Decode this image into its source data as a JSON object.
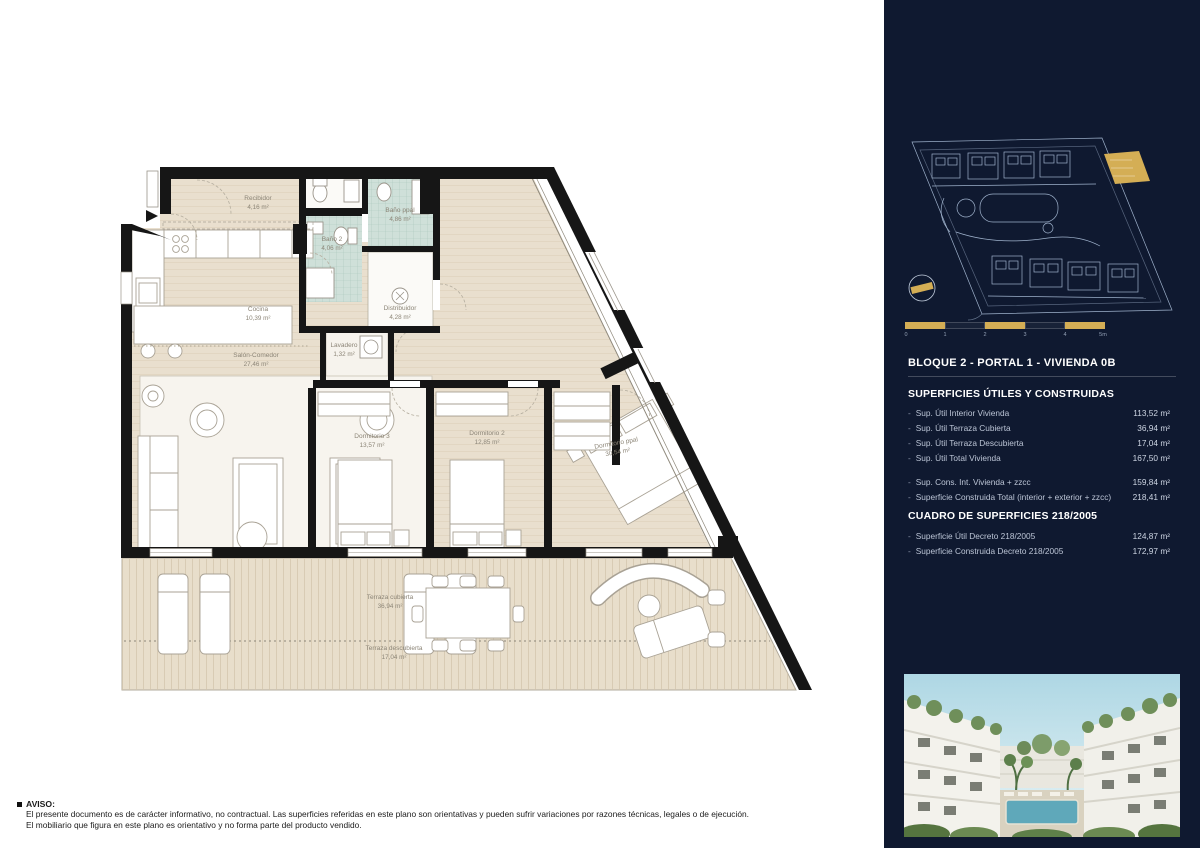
{
  "colors": {
    "navy": "#0f1930",
    "gold": "#d4ae55",
    "floor_beige": "#e9dfce",
    "bath_teal": "#cfe0d9"
  },
  "floorplan": {
    "rooms": {
      "recibidor": {
        "name": "Recibidor",
        "area": "4,16 m²"
      },
      "cocina": {
        "name": "Cocina",
        "area": "10,39 m²"
      },
      "bano2": {
        "name": "Baño 2",
        "area": "4,06 m²"
      },
      "banoppal": {
        "name": "Baño ppal",
        "area": "4,86 m²"
      },
      "distribuidor": {
        "name": "Distribuidor",
        "area": "4,28 m²"
      },
      "lavadero": {
        "name": "Lavadero",
        "area": "1,32 m²"
      },
      "salon": {
        "name": "Salón-Comedor",
        "area": "27,46 m²"
      },
      "dorm3": {
        "name": "Dormitorio 3",
        "area": "13,57 m²"
      },
      "dorm2": {
        "name": "Dormitorio 2",
        "area": "12,85 m²"
      },
      "dormppal": {
        "name": "Dormitorio ppal",
        "area": "30,54 m²"
      },
      "terraza_cub": {
        "name": "Terraza cubierta",
        "area": "36,94 m²"
      },
      "terraza_desc": {
        "name": "Terraza descubierta",
        "area": "17,04 m²"
      }
    }
  },
  "sidebar": {
    "unit_title": "BLOQUE 2 - PORTAL 1 - VIVIENDA 0B",
    "superficies": {
      "title": "SUPERFICIES ÚTILES Y CONSTRUIDAS",
      "rows": [
        {
          "label": "Sup. Útil Interior Vivienda",
          "value": "113,52 m²"
        },
        {
          "label": "Sup. Útil Terraza Cubierta",
          "value": "36,94 m²"
        },
        {
          "label": "Sup. Útil Terraza Descubierta",
          "value": "17,04 m²"
        },
        {
          "label": "Sup. Útil Total Vivienda",
          "value": "167,50 m²"
        },
        {
          "label": "Sup. Cons. Int. Vivienda + zzcc",
          "value": "159,84 m²"
        },
        {
          "label": "Superficie Construida Total (interior + exterior + zzcc)",
          "value": "218,41 m²"
        }
      ]
    },
    "cuadro": {
      "title": "CUADRO DE SUPERFICIES 218/2005",
      "rows": [
        {
          "label": "Superficie Útil Decreto 218/2005",
          "value": "124,87 m²"
        },
        {
          "label": "Superficie Construida Decreto 218/2005",
          "value": "172,97 m²"
        }
      ]
    },
    "scalebar": {
      "labels": [
        "0",
        "1",
        "2",
        "3",
        "4",
        "5m"
      ]
    }
  },
  "disclaimer": {
    "title": "AVISO:",
    "line1": "El presente documento es de carácter informativo, no contractual. Las superficies referidas en este plano son orientativas y pueden sufrir variaciones por razones técnicas, legales o de ejecución.",
    "line2": "El mobiliario que figura en este plano es orientativo y no forma parte del producto vendido."
  }
}
